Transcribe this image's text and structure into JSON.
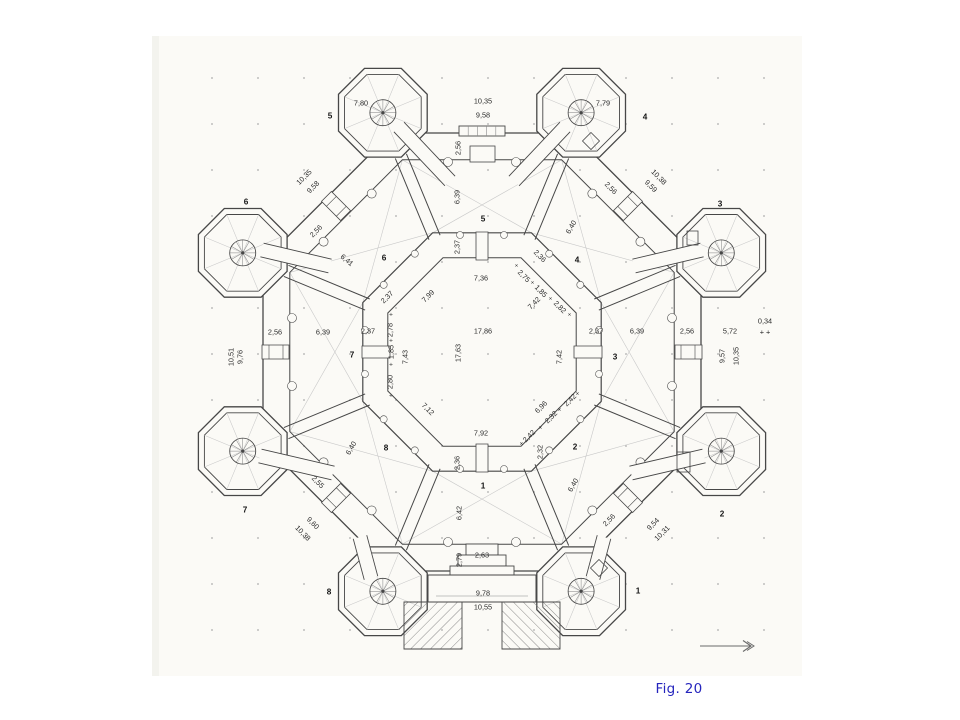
{
  "figure": {
    "caption": "Fig. 20",
    "caption_color": "#2525bd"
  },
  "drawing": {
    "kind": "octagonal-castle-floor-plan",
    "colors": {
      "ink": "#474747",
      "paper": "#fbfaf6",
      "light": "#c9c9c9",
      "detail": "#8a8a8a"
    },
    "labels": [
      {
        "t": "10,35",
        "x": 483,
        "y": 101
      },
      {
        "t": "9,58",
        "x": 483,
        "y": 115
      },
      {
        "t": "7,80",
        "x": 361,
        "y": 103
      },
      {
        "t": "7,79",
        "x": 603,
        "y": 103
      },
      {
        "t": "7,36",
        "x": 481,
        "y": 278
      },
      {
        "t": "17,86",
        "x": 483,
        "y": 331
      },
      {
        "t": "7,92",
        "x": 481,
        "y": 433
      },
      {
        "t": "2,63",
        "x": 482,
        "y": 555
      },
      {
        "t": "9,78",
        "x": 483,
        "y": 593
      },
      {
        "t": "10,55",
        "x": 483,
        "y": 607
      },
      {
        "t": "2,56",
        "x": 275,
        "y": 332
      },
      {
        "t": "6,39",
        "x": 323,
        "y": 332
      },
      {
        "t": "2,37",
        "x": 368,
        "y": 331
      },
      {
        "t": "2,37",
        "x": 596,
        "y": 331
      },
      {
        "t": "6,39",
        "x": 637,
        "y": 331
      },
      {
        "t": "2,56",
        "x": 687,
        "y": 331
      },
      {
        "t": "5,72",
        "x": 730,
        "y": 331
      },
      {
        "t": "0,34",
        "x": 765,
        "y": 321
      },
      {
        "t": "+ +",
        "x": 765,
        "y": 332
      },
      {
        "t": "2,56",
        "x": 458,
        "y": 148,
        "r": -90
      },
      {
        "t": "6,39",
        "x": 457,
        "y": 197,
        "r": -90
      },
      {
        "t": "2,37",
        "x": 457,
        "y": 247,
        "r": -90
      },
      {
        "t": "17,63",
        "x": 458,
        "y": 353,
        "r": -90
      },
      {
        "t": "7,43",
        "x": 405,
        "y": 357,
        "r": -90
      },
      {
        "t": "7,42",
        "x": 559,
        "y": 357,
        "r": -90
      },
      {
        "t": "2,78",
        "x": 390,
        "y": 330,
        "r": -90
      },
      {
        "t": "1,85",
        "x": 391,
        "y": 352,
        "r": -90
      },
      {
        "t": "2,80",
        "x": 390,
        "y": 382,
        "r": -90
      },
      {
        "t": "10,51",
        "x": 231,
        "y": 357,
        "r": -90
      },
      {
        "t": "9,76",
        "x": 240,
        "y": 357,
        "r": -90
      },
      {
        "t": "9,57",
        "x": 722,
        "y": 356,
        "r": -90
      },
      {
        "t": "10,35",
        "x": 736,
        "y": 356,
        "r": -90
      },
      {
        "t": "2,36",
        "x": 457,
        "y": 463,
        "r": -90
      },
      {
        "t": "6,42",
        "x": 459,
        "y": 513,
        "r": -90
      },
      {
        "t": "2,79",
        "x": 459,
        "y": 560,
        "r": -90
      },
      {
        "t": "2,32",
        "x": 540,
        "y": 452,
        "r": -90
      },
      {
        "t": "10,35",
        "x": 304,
        "y": 177,
        "r": -45
      },
      {
        "t": "9,58",
        "x": 313,
        "y": 187,
        "r": -45
      },
      {
        "t": "2,56",
        "x": 316,
        "y": 231,
        "r": -45
      },
      {
        "t": "2,37",
        "x": 387,
        "y": 297,
        "r": -45
      },
      {
        "t": "7,99",
        "x": 428,
        "y": 296,
        "r": -45
      },
      {
        "t": "7,42",
        "x": 534,
        "y": 303,
        "r": -45
      },
      {
        "t": "2,56",
        "x": 609,
        "y": 520,
        "r": -45
      },
      {
        "t": "9,54",
        "x": 653,
        "y": 524,
        "r": -45
      },
      {
        "t": "10,31",
        "x": 662,
        "y": 533,
        "r": -45
      },
      {
        "t": "2,42",
        "x": 570,
        "y": 400,
        "r": -45
      },
      {
        "t": "2,32",
        "x": 551,
        "y": 417,
        "r": -45
      },
      {
        "t": "2,42",
        "x": 529,
        "y": 436,
        "r": -45
      },
      {
        "t": "6,96",
        "x": 541,
        "y": 407,
        "r": -45
      },
      {
        "t": "10,38",
        "x": 659,
        "y": 177,
        "r": 45
      },
      {
        "t": "9,59",
        "x": 651,
        "y": 186,
        "r": 45
      },
      {
        "t": "2,56",
        "x": 611,
        "y": 188,
        "r": 45
      },
      {
        "t": "2,36",
        "x": 540,
        "y": 256,
        "r": 45
      },
      {
        "t": "2,75",
        "x": 524,
        "y": 276,
        "r": 45
      },
      {
        "t": "1,85",
        "x": 541,
        "y": 291,
        "r": 45
      },
      {
        "t": "2,82",
        "x": 560,
        "y": 307,
        "r": 45
      },
      {
        "t": "2,55",
        "x": 318,
        "y": 482,
        "r": 45
      },
      {
        "t": "9,60",
        "x": 313,
        "y": 523,
        "r": 45
      },
      {
        "t": "10,38",
        "x": 303,
        "y": 533,
        "r": 45
      },
      {
        "t": "7,12",
        "x": 428,
        "y": 409,
        "r": 45
      },
      {
        "t": "6,41",
        "x": 347,
        "y": 260,
        "r": 40
      },
      {
        "t": "6,40",
        "x": 571,
        "y": 227,
        "r": -60
      },
      {
        "t": "6,40",
        "x": 573,
        "y": 485,
        "r": -60
      },
      {
        "t": "6,40",
        "x": 351,
        "y": 448,
        "r": -60
      },
      {
        "t": "+",
        "x": 391,
        "y": 315,
        "k": "plus"
      },
      {
        "t": "+",
        "x": 391,
        "y": 341,
        "k": "plus"
      },
      {
        "t": "+",
        "x": 391,
        "y": 365,
        "k": "plus"
      },
      {
        "t": "+",
        "x": 391,
        "y": 396,
        "k": "plus"
      },
      {
        "t": "+",
        "x": 516,
        "y": 266,
        "r": 45,
        "k": "plus"
      },
      {
        "t": "+",
        "x": 532,
        "y": 283,
        "r": 45,
        "k": "plus"
      },
      {
        "t": "+",
        "x": 550,
        "y": 299,
        "r": 45,
        "k": "plus"
      },
      {
        "t": "+",
        "x": 569,
        "y": 315,
        "r": 45,
        "k": "plus"
      },
      {
        "t": "+",
        "x": 578,
        "y": 394,
        "r": -45,
        "k": "plus"
      },
      {
        "t": "+",
        "x": 560,
        "y": 410,
        "r": -45,
        "k": "plus"
      },
      {
        "t": "+",
        "x": 541,
        "y": 428,
        "r": -45,
        "k": "plus"
      },
      {
        "t": "+",
        "x": 522,
        "y": 444,
        "r": -45,
        "k": "plus"
      },
      {
        "t": "1",
        "x": 483,
        "y": 486,
        "k": "room"
      },
      {
        "t": "2",
        "x": 575,
        "y": 447,
        "k": "room"
      },
      {
        "t": "3",
        "x": 615,
        "y": 357,
        "k": "room"
      },
      {
        "t": "4",
        "x": 577,
        "y": 260,
        "k": "room"
      },
      {
        "t": "5",
        "x": 483,
        "y": 219,
        "k": "room"
      },
      {
        "t": "6",
        "x": 384,
        "y": 258,
        "k": "room"
      },
      {
        "t": "7",
        "x": 352,
        "y": 355,
        "k": "room"
      },
      {
        "t": "8",
        "x": 386,
        "y": 448,
        "k": "room"
      },
      {
        "t": "1",
        "x": 638,
        "y": 591,
        "k": "tower"
      },
      {
        "t": "2",
        "x": 722,
        "y": 514,
        "k": "tower"
      },
      {
        "t": "3",
        "x": 720,
        "y": 204,
        "k": "tower"
      },
      {
        "t": "4",
        "x": 645,
        "y": 117,
        "k": "tower"
      },
      {
        "t": "5",
        "x": 330,
        "y": 116,
        "k": "tower"
      },
      {
        "t": "6",
        "x": 246,
        "y": 202,
        "k": "tower"
      },
      {
        "t": "7",
        "x": 245,
        "y": 510,
        "k": "tower"
      },
      {
        "t": "8",
        "x": 329,
        "y": 592,
        "k": "tower"
      }
    ]
  }
}
